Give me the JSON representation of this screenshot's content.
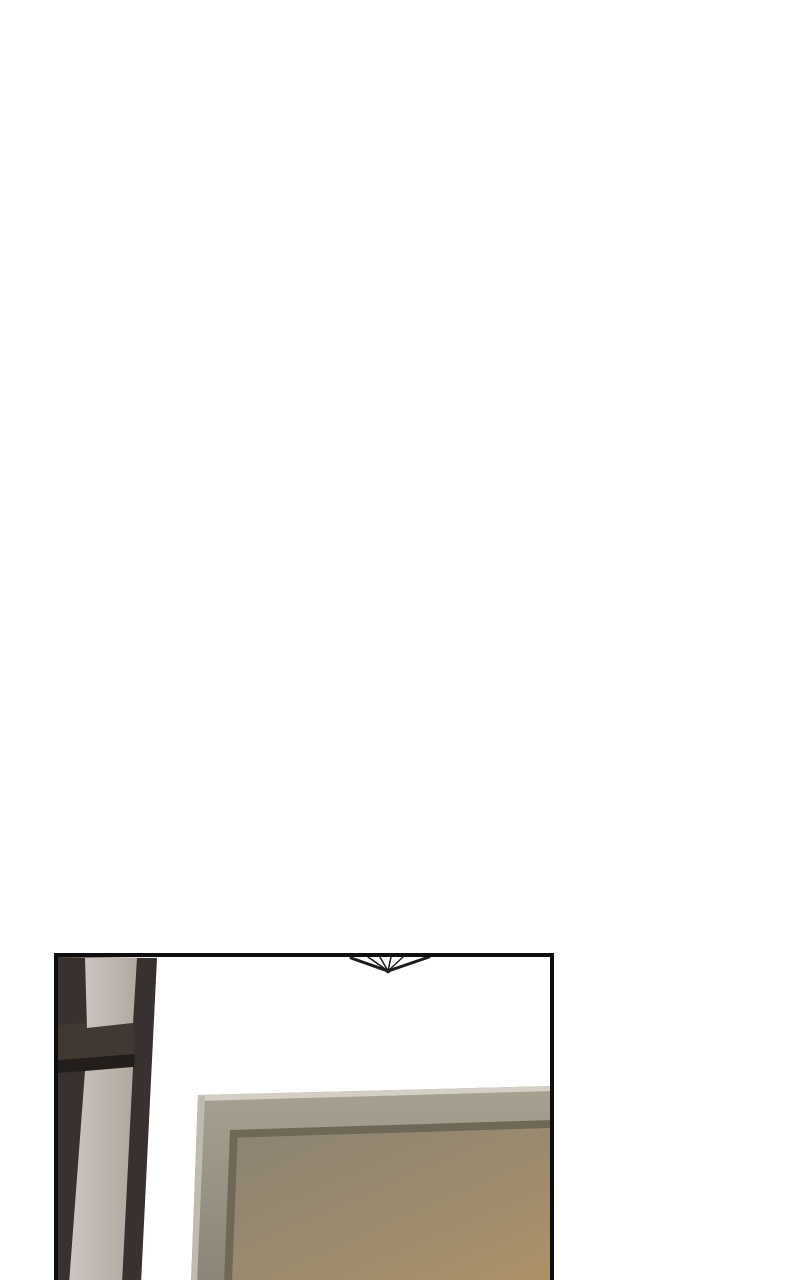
{
  "scene": {
    "type": "comic-panel",
    "description": "Interior scene: dark lattice partition at left, hanging ceiling ornament at top center, large door with recessed panel glowing warm tan at bottom right",
    "elements": [
      "lattice-partition",
      "ceiling-ornament",
      "door-with-recessed-panel"
    ]
  },
  "colors": {
    "page_bg": "#ffffff",
    "panel_bg": "#ffffff",
    "panel_border": "#0e0e0e",
    "ornament": "#1c1c1c",
    "partition_frame": "#38312d",
    "partition_rail": "#413931",
    "partition_shadow": "#231e1c",
    "pane_light": "#cbc5c1",
    "pane_shade": "#b1a99e",
    "door_frame_light": "#a7a192",
    "door_frame_dark": "#8b8575",
    "door_top_highlight": "#d3cfc4",
    "door_edge_highlight": "#c1bbaf",
    "door_groove": "#6f6857",
    "door_inner_top": "#8b8373",
    "door_inner_mid": "#98896f",
    "door_inner_warm": "#ac9168"
  }
}
